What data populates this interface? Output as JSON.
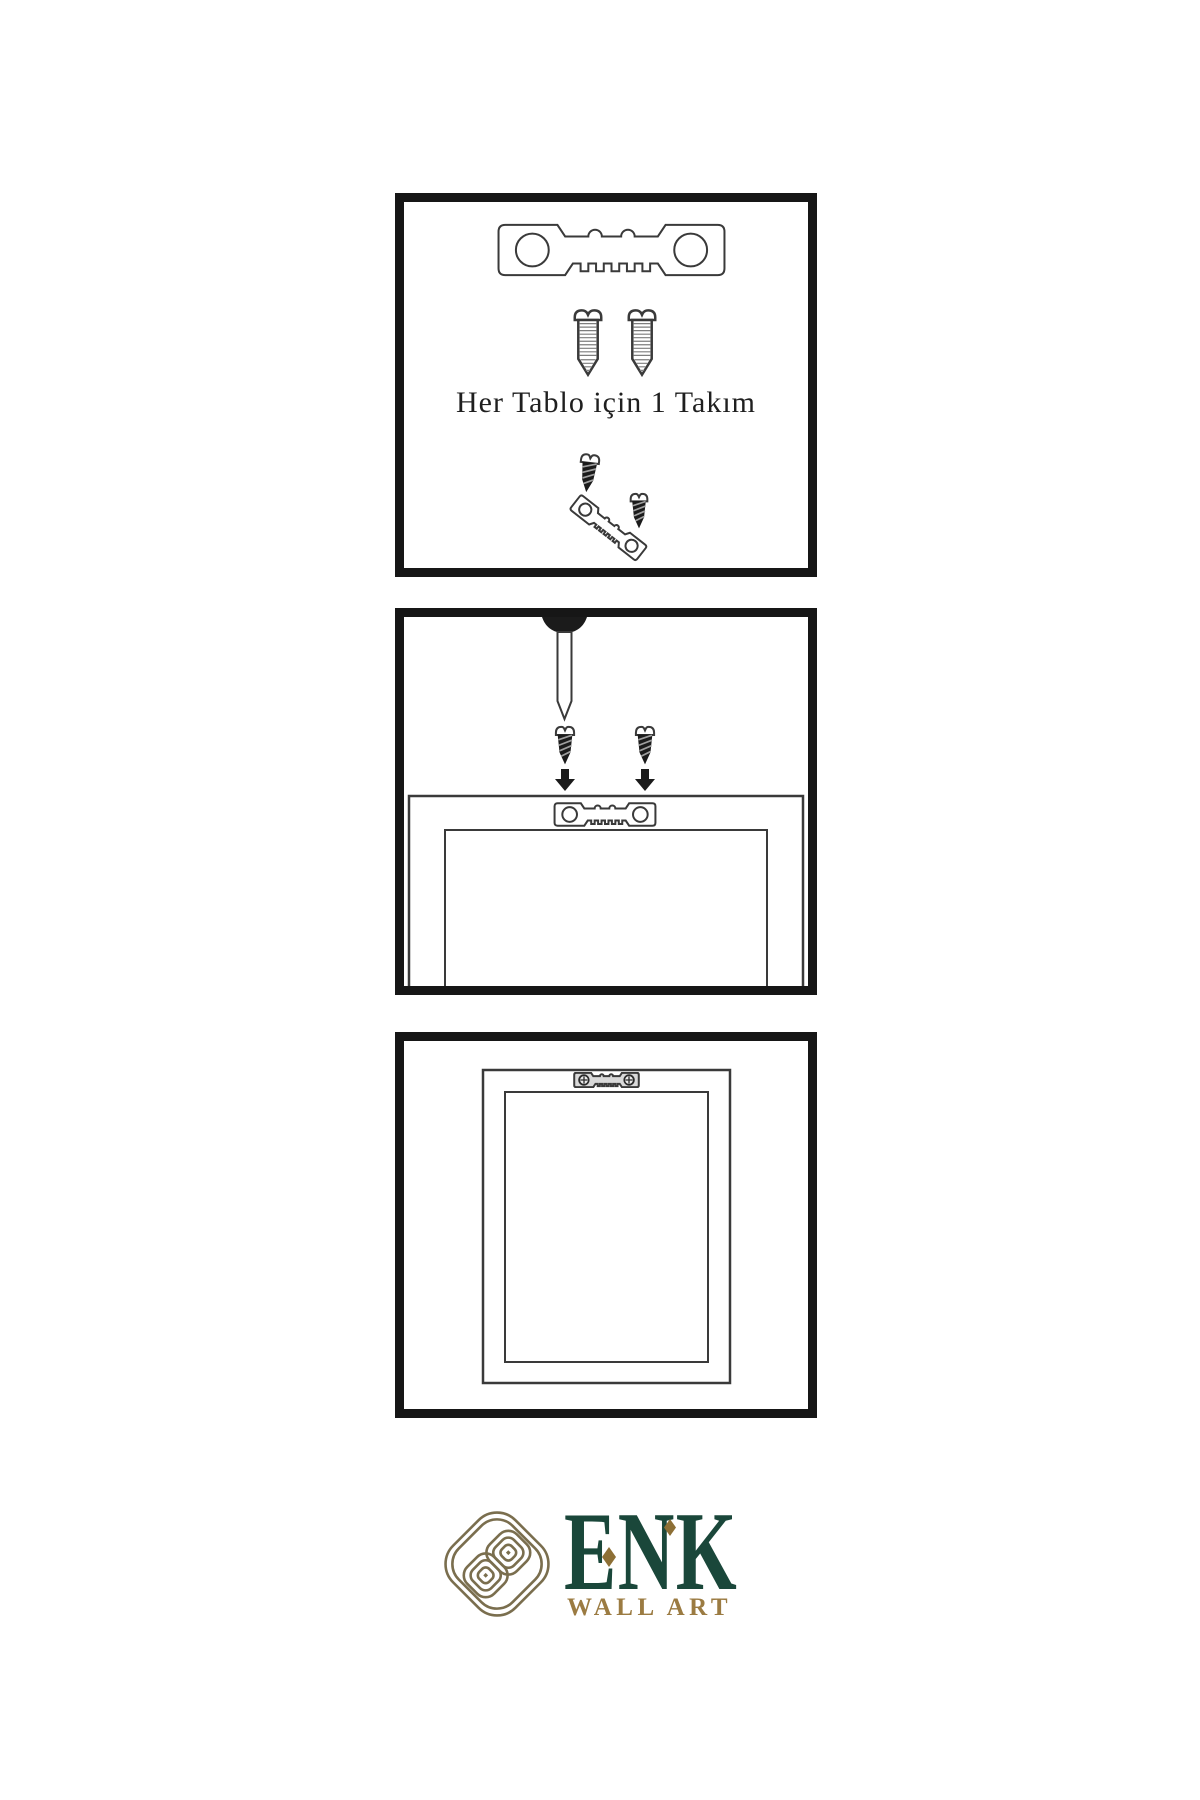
{
  "panels": {
    "kit": {
      "caption": "Her Tablo için 1 Takım",
      "icons": [
        "sawtooth-hanger-icon",
        "screw-icon",
        "screw-icon",
        "screw-icon",
        "screw-icon",
        "tilted-sawtooth-hanger-icon"
      ]
    },
    "install": {
      "icons": [
        "wall-nail-icon",
        "screw-icon",
        "screw-icon",
        "arrow-down-icon",
        "arrow-down-icon",
        "frame-back-icon",
        "sawtooth-hanger-icon"
      ]
    },
    "hang": {
      "icons": [
        "frame-back-icon",
        "installed-sawtooth-hanger-icon",
        "screw-head-icon",
        "screw-head-icon"
      ]
    }
  },
  "logo": {
    "brand": "ENK",
    "subtitle": "WALL ART",
    "icon": "knot-logo-icon"
  },
  "colors": {
    "line": "#3a3a3a",
    "dark": "#1b1b1b",
    "border": "#161616",
    "green": "#1a473a",
    "gold": "#9b7b42",
    "knot": "#7a6e4e",
    "diamond": "#8d6f35"
  }
}
